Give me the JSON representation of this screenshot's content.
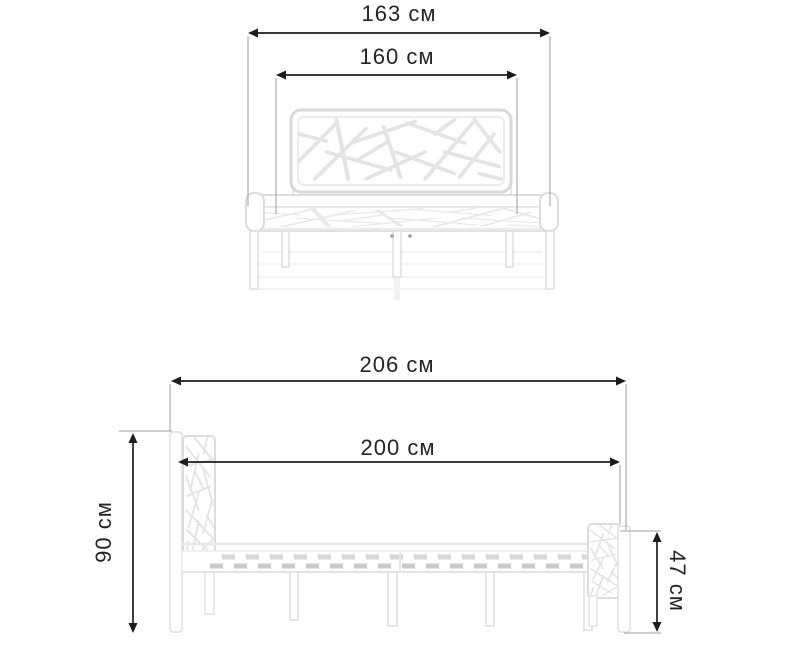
{
  "unit": "см",
  "dimensions": {
    "front_view": {
      "outer_width": {
        "label": "163 см",
        "value": 163
      },
      "inner_width": {
        "label": "160 см",
        "value": 160
      }
    },
    "side_view": {
      "outer_length": {
        "label": "206 см",
        "value": 206
      },
      "inner_length": {
        "label": "200 см",
        "value": 200
      },
      "headboard_height": {
        "label": "90 см",
        "value": 90
      },
      "footboard_height": {
        "label": "47 см",
        "value": 47
      }
    }
  },
  "colors": {
    "background": "#ffffff",
    "dimension_line": "#1c1c1c",
    "extension_line": "#9c9c9c",
    "label_text": "#242424",
    "bed_outline": "#dcdcdc",
    "bed_pattern": "#e4e4e4",
    "slat": "#c9c9c9"
  }
}
